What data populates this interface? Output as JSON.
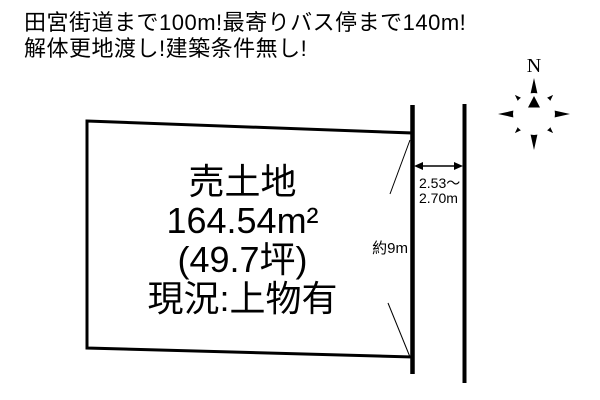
{
  "header": {
    "line1": "田宮街道まで100m!最寄りバス停まで140m!",
    "line2": "解体更地渡し!建築条件無し!"
  },
  "plot": {
    "title": "売土地",
    "area_sqm": "164.54m²",
    "area_tsubo": "(49.7坪)",
    "status": "現況:上物有"
  },
  "road": {
    "width_line1": "2.53〜",
    "width_line2": "2.70m",
    "frontage": "約9m"
  },
  "compass": {
    "north": "N"
  },
  "colors": {
    "ink": "#000000",
    "paper": "#ffffff"
  }
}
